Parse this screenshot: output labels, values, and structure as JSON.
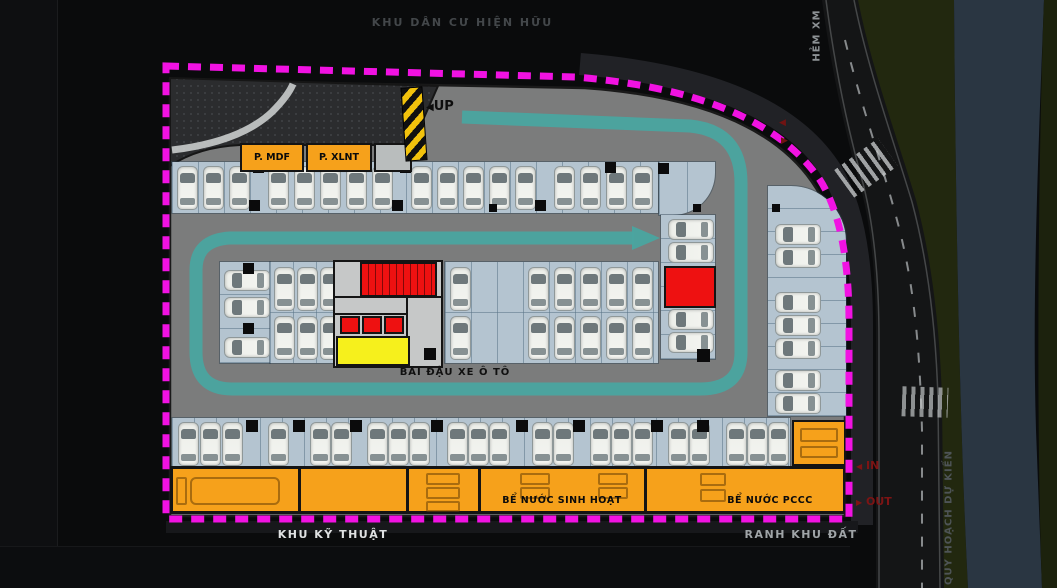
{
  "labels": {
    "residential_area": "KHU DÂN CƯ HIỆN HỮU",
    "alley": "HẺM XM",
    "planned_road": "QUY HOẠCH DỰ KIẾN",
    "site_boundary": "RANH KHU ĐẤT",
    "technical_zone": "KHU KỸ THUẬT",
    "parking_area": "BÃI ĐẬU XE Ô TÔ",
    "ramp_up": "UP",
    "room_mdf": "P. MDF",
    "room_xlnt": "P. XLNT",
    "water_tank_domestic": "BỂ NƯỚC SINH HOẠT",
    "water_tank_fire": "BỂ NƯỚC PCCC",
    "gate_in": "IN",
    "gate_out": "OUT"
  },
  "icons": {
    "arrow_left": "◀",
    "arrow_right": "▶"
  },
  "colors": {
    "boundary_magenta": "#f112e2",
    "circulation_teal": "#4aa5a0",
    "floor_gray": "#7b7c7c",
    "stall_blue": "#b4c4d0",
    "room_orange": "#f6a11b",
    "core_red": "#ee1111",
    "room_yellow": "#f6f01c",
    "gate_text_red": "#7d1414",
    "greenery": "#22280f",
    "water": "#2a3642"
  },
  "parking": {
    "zones": [
      {
        "x": 172,
        "y": 162,
        "w": 486,
        "h": 51,
        "dir": "v",
        "step": 26
      },
      {
        "x": 659,
        "y": 162,
        "w": 56,
        "h": 53,
        "dir": "v",
        "step": 28,
        "round": "br"
      },
      {
        "x": 661,
        "y": 215,
        "w": 54,
        "h": 144,
        "dir": "h",
        "step": 24
      },
      {
        "x": 768,
        "y": 186,
        "w": 78,
        "h": 230,
        "dir": "h",
        "step": 23,
        "round": "tr"
      },
      {
        "x": 220,
        "y": 262,
        "w": 50,
        "h": 101,
        "dir": "h",
        "step": 34
      },
      {
        "x": 270,
        "y": 262,
        "w": 70,
        "h": 101,
        "dir": "v2",
        "step": 23
      },
      {
        "x": 445,
        "y": 262,
        "w": 213,
        "h": 101,
        "dir": "v2",
        "step": 26
      },
      {
        "x": 172,
        "y": 418,
        "w": 618,
        "h": 50,
        "dir": "v",
        "step": 22
      }
    ],
    "cars_vertical": [
      [
        177,
        166
      ],
      [
        203,
        166
      ],
      [
        229,
        166
      ],
      [
        268,
        166
      ],
      [
        294,
        166
      ],
      [
        320,
        166
      ],
      [
        346,
        166
      ],
      [
        372,
        166
      ],
      [
        411,
        166
      ],
      [
        437,
        166
      ],
      [
        463,
        166
      ],
      [
        489,
        166
      ],
      [
        515,
        166
      ],
      [
        554,
        166
      ],
      [
        580,
        166
      ],
      [
        606,
        166
      ],
      [
        632,
        166
      ],
      [
        274,
        267
      ],
      [
        297,
        267
      ],
      [
        320,
        267
      ],
      [
        274,
        316
      ],
      [
        297,
        316
      ],
      [
        320,
        316
      ],
      [
        450,
        267
      ],
      [
        528,
        267
      ],
      [
        554,
        267
      ],
      [
        580,
        267
      ],
      [
        606,
        267
      ],
      [
        632,
        267
      ],
      [
        450,
        316
      ],
      [
        528,
        316
      ],
      [
        554,
        316
      ],
      [
        580,
        316
      ],
      [
        606,
        316
      ],
      [
        632,
        316
      ],
      [
        178,
        422
      ],
      [
        200,
        422
      ],
      [
        222,
        422
      ],
      [
        268,
        422
      ],
      [
        310,
        422
      ],
      [
        331,
        422
      ],
      [
        367,
        422
      ],
      [
        388,
        422
      ],
      [
        409,
        422
      ],
      [
        447,
        422
      ],
      [
        468,
        422
      ],
      [
        489,
        422
      ],
      [
        532,
        422
      ],
      [
        553,
        422
      ],
      [
        590,
        422
      ],
      [
        611,
        422
      ],
      [
        632,
        422
      ],
      [
        668,
        422
      ],
      [
        689,
        422
      ],
      [
        726,
        422
      ],
      [
        747,
        422
      ],
      [
        768,
        422
      ]
    ],
    "cars_horizontal": [
      [
        224,
        270
      ],
      [
        224,
        297
      ],
      [
        224,
        337
      ],
      [
        668,
        219
      ],
      [
        668,
        242
      ],
      [
        668,
        309
      ],
      [
        668,
        332
      ],
      [
        775,
        224
      ],
      [
        775,
        247
      ],
      [
        775,
        292
      ],
      [
        775,
        315
      ],
      [
        775,
        338
      ],
      [
        775,
        370
      ],
      [
        775,
        393
      ]
    ],
    "columns": [
      [
        249,
        200,
        11
      ],
      [
        392,
        200,
        11
      ],
      [
        535,
        200,
        11
      ],
      [
        253,
        162,
        11
      ],
      [
        400,
        162,
        11
      ],
      [
        605,
        162,
        11
      ],
      [
        658,
        163,
        11
      ],
      [
        489,
        204,
        8
      ],
      [
        693,
        204,
        8
      ],
      [
        772,
        204,
        8
      ],
      [
        243,
        263,
        11
      ],
      [
        243,
        323,
        11
      ],
      [
        697,
        349,
        13
      ],
      [
        246,
        420,
        12
      ],
      [
        293,
        420,
        12
      ],
      [
        350,
        420,
        12
      ],
      [
        431,
        420,
        12
      ],
      [
        516,
        420,
        12
      ],
      [
        573,
        420,
        12
      ],
      [
        651,
        420,
        12
      ],
      [
        697,
        420,
        12
      ]
    ]
  }
}
